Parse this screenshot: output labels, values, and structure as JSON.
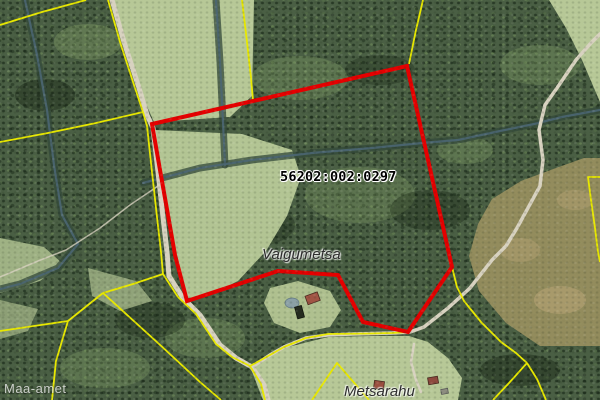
{
  "map": {
    "type": "aerial-cadastral-view",
    "labels": {
      "cadastral_code": "56202:002:0297",
      "place_1": "Vaigumetsa",
      "place_2": "Metsarahu"
    },
    "watermark": "Maa-amet",
    "features": {
      "selected_parcel": "red outlined cadastral parcel",
      "boundaries": "yellow cadastral boundary lines",
      "roads": "gravel roads and trails",
      "streams": "dark tree-lined ditches"
    },
    "colors": {
      "parcel_outline": "#e60000",
      "cadastral_boundary": "#e8e800",
      "forest": "#4a5f44",
      "field": "#b7c897",
      "road": "#d8d2c0",
      "stream": "#4b6672",
      "label_text": "#000000",
      "watermark_text": "#ffffff"
    }
  }
}
